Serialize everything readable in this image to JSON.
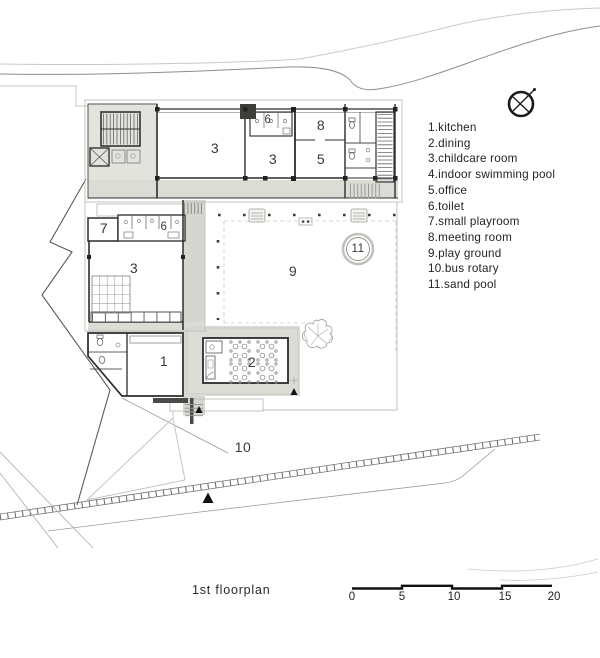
{
  "caption": "1st floorplan",
  "legend": {
    "items": [
      {
        "text": "1.kitchen"
      },
      {
        "text": "2.dining"
      },
      {
        "text": "3.childcare room"
      },
      {
        "text": "4.indoor swimming pool"
      },
      {
        "text": "5.office"
      },
      {
        "text": "6.toilet"
      },
      {
        "text": "7.small playroom"
      },
      {
        "text": "8.meeting room"
      },
      {
        "text": "9.play ground"
      },
      {
        "text": "10.bus rotary"
      },
      {
        "text": "11.sand pool"
      }
    ]
  },
  "plan": {
    "labels": [
      {
        "room": "childcare-room-a",
        "text": "3"
      },
      {
        "room": "toilet-north",
        "text": "6"
      },
      {
        "room": "meeting-room",
        "text": "8"
      },
      {
        "room": "childcare-room-b",
        "text": "3"
      },
      {
        "room": "office",
        "text": "5"
      },
      {
        "room": "small-playroom",
        "text": "7"
      },
      {
        "room": "toilet-west",
        "text": "6"
      },
      {
        "room": "childcare-room-c",
        "text": "3"
      },
      {
        "room": "play-ground",
        "text": "9"
      },
      {
        "room": "sand-pool",
        "text": "11"
      },
      {
        "room": "kitchen",
        "text": "1"
      },
      {
        "room": "dining",
        "text": "2"
      },
      {
        "room": "bus-rotary",
        "text": "10"
      }
    ]
  },
  "scale_bar": {
    "labels": [
      "0",
      "5",
      "10",
      "15",
      "20"
    ]
  },
  "colors": {
    "wall": "#2b2b2b",
    "light_line": "#bdbdb8",
    "floor_gray": "#dcdcd7",
    "text": "#2e2e2e"
  }
}
